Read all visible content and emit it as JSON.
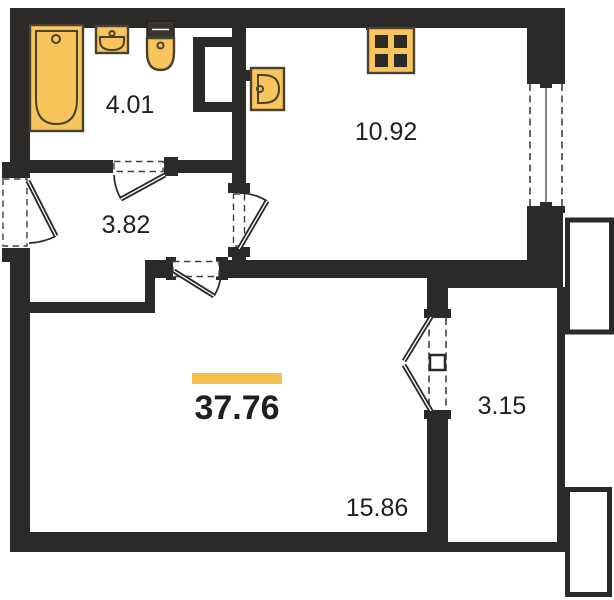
{
  "plan": {
    "type": "apartment-floor-plan",
    "total_area_label": "37.76",
    "rooms": [
      {
        "name": "bathroom",
        "area_label": "4.01"
      },
      {
        "name": "hallway",
        "area_label": "3.82"
      },
      {
        "name": "kitchen",
        "area_label": "10.92"
      },
      {
        "name": "living-room",
        "area_label": "15.86"
      },
      {
        "name": "balcony",
        "area_label": "3.15"
      }
    ],
    "fixtures": [
      "bathtub",
      "bathroom-sink",
      "toilet",
      "kitchen-wall-sink",
      "stove",
      "kitchen-window",
      "french-balcony-door",
      "entry-door"
    ],
    "colors": {
      "wall": "#2b2a28",
      "fixture_fill": "#f7c55c",
      "fixture_stroke": "#4a4130",
      "accent_bar": "#f3c04c",
      "text": "#1f1f1f",
      "background": "#ffffff"
    }
  }
}
